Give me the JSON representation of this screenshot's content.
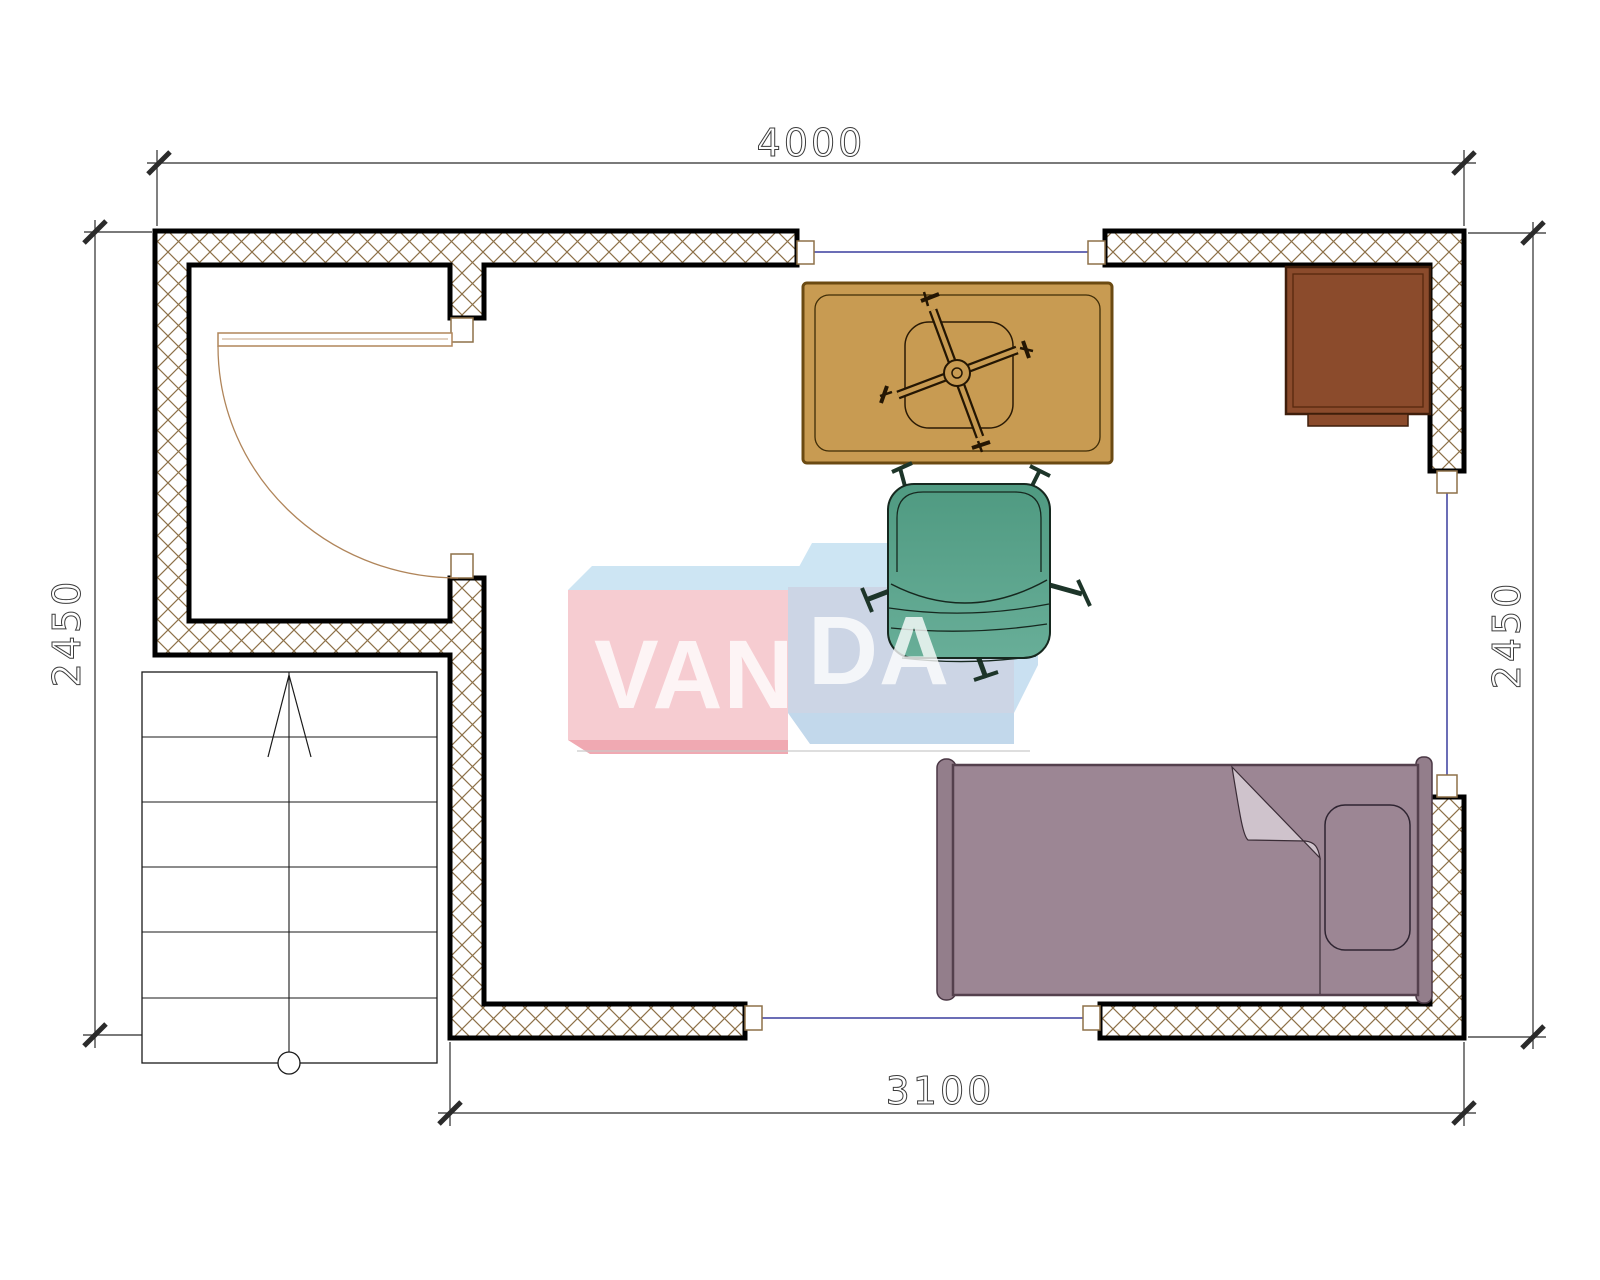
{
  "page": {
    "background": "#ffffff",
    "type": "architectural-floor-plan"
  },
  "dimensions": {
    "top": "4000",
    "left": "2450",
    "right": "2450",
    "bottom": "3100"
  },
  "watermark": {
    "text": "VANDA",
    "part1": "VAN",
    "part2": "DA"
  },
  "elements": {
    "door": "hinged swing door with quarter-circle arc",
    "stairs": "exterior staircase with up-direction arrow",
    "windows": "three window openings with glass line",
    "furniture": [
      "desk with chair base",
      "office chair",
      "cabinet",
      "single bed with pillow"
    ]
  },
  "colors": {
    "wall_hatch": "#8d7148",
    "wall_outline": "#000000",
    "window_glass": "#3a3d9e",
    "door_frame": "#b0855a",
    "desk": "#c89b52",
    "cabinet": "#8b4b2c",
    "chair": "#57a18b",
    "bed": "#9c8694",
    "watermark_pink": "#f6ccd1",
    "watermark_blue": "#ccd5e5",
    "watermark_sky": "#cde5f3"
  }
}
